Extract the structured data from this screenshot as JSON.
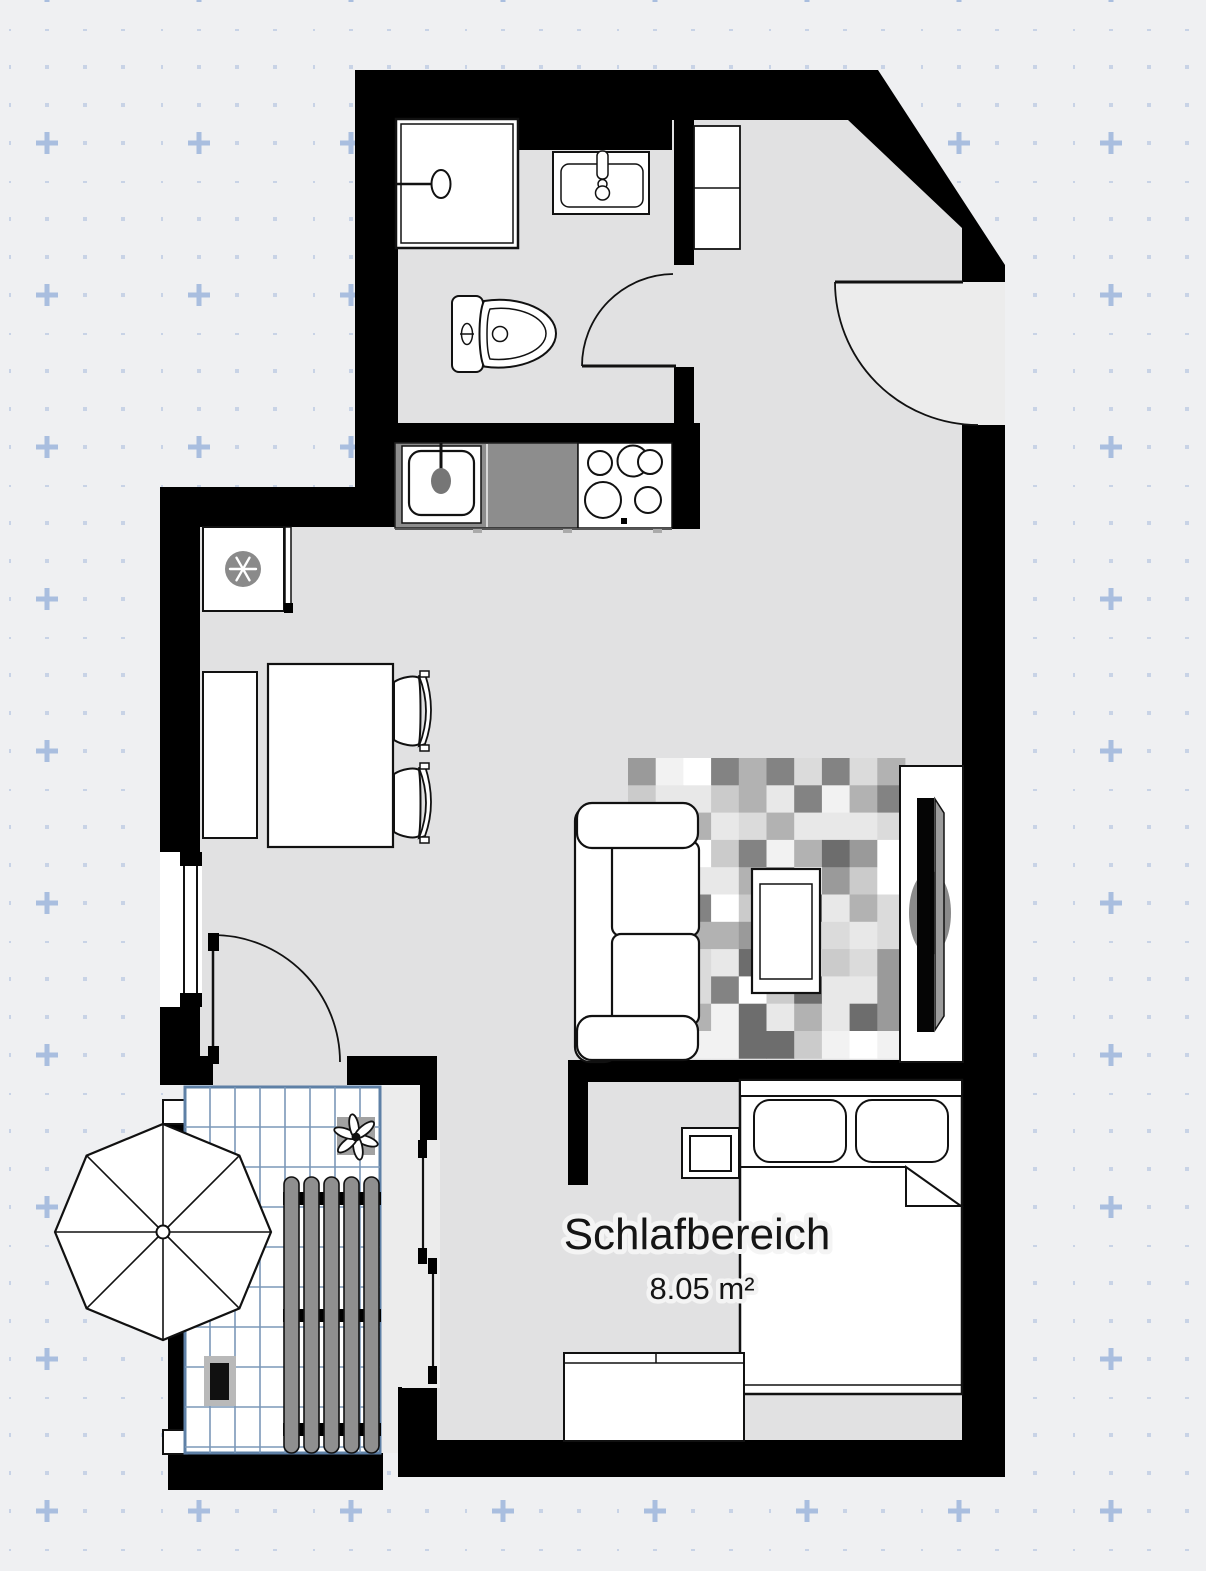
{
  "canvas": {
    "width": 1206,
    "height": 1571,
    "background": "#eff0f2"
  },
  "grid": {
    "dot_color": "#c8d3e6",
    "cross_color": "#a9bedf",
    "dot_spacing_px": 38,
    "cross_spacing_px": 152
  },
  "plan": {
    "labels": {
      "sleeping_room_name": "Schlafbereich",
      "sleeping_room_area": "8.05 m²"
    },
    "colors": {
      "wall": "#000000",
      "floor": "#e1e1e2",
      "door_swing": "#ececec",
      "kitchen_counter": "#8d8d8d",
      "fixture_gray": "#8a8a8a",
      "lounger_slat": "#8f8f8f",
      "tv_back_panel": "#9c9c9c",
      "balcony_tile_line": "#7b98b8",
      "balcony_tile_border": "#5e80a6",
      "rug_palette": [
        "#ffffff",
        "#f2f2f2",
        "#e8e8e8",
        "#dbdbdb",
        "#cbcbcb",
        "#b2b2b2",
        "#9a9a9a",
        "#838383",
        "#6d6d6d"
      ]
    },
    "rug": {
      "x": 628,
      "y": 758,
      "cols": 10,
      "rows": 11,
      "cell_w": 27.7,
      "cell_h": 27.3
    }
  }
}
